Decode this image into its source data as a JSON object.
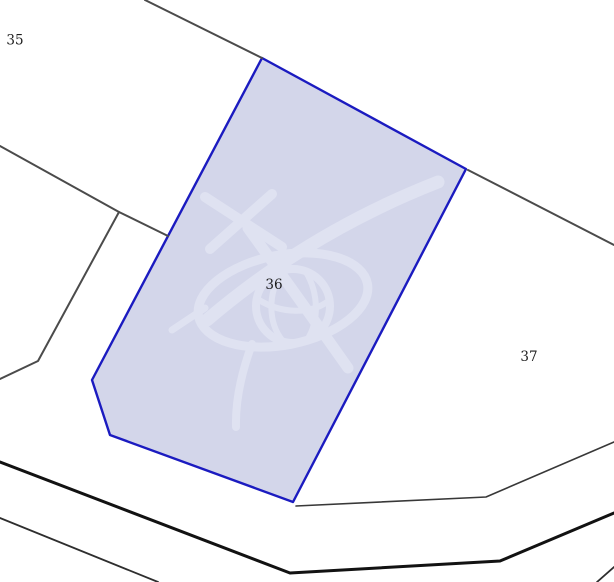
{
  "map": {
    "type": "cadastral-parcel-map",
    "selected_parcel": "36",
    "parcels": [
      {
        "label": "35",
        "selected": false
      },
      {
        "label": "36",
        "selected": true
      },
      {
        "label": "37",
        "selected": false
      }
    ],
    "watermark": "cadastre-surveying-emblem",
    "colors": {
      "background": "#ffffff",
      "selected_parcel_fill": "#d3d6ea",
      "selected_parcel_border": "#1b1bc0",
      "boundary_line": "#4b4b4b",
      "road_line": "#121212",
      "watermark_tint": "#dfe2f1",
      "label_text": "#1c1c1c"
    }
  }
}
